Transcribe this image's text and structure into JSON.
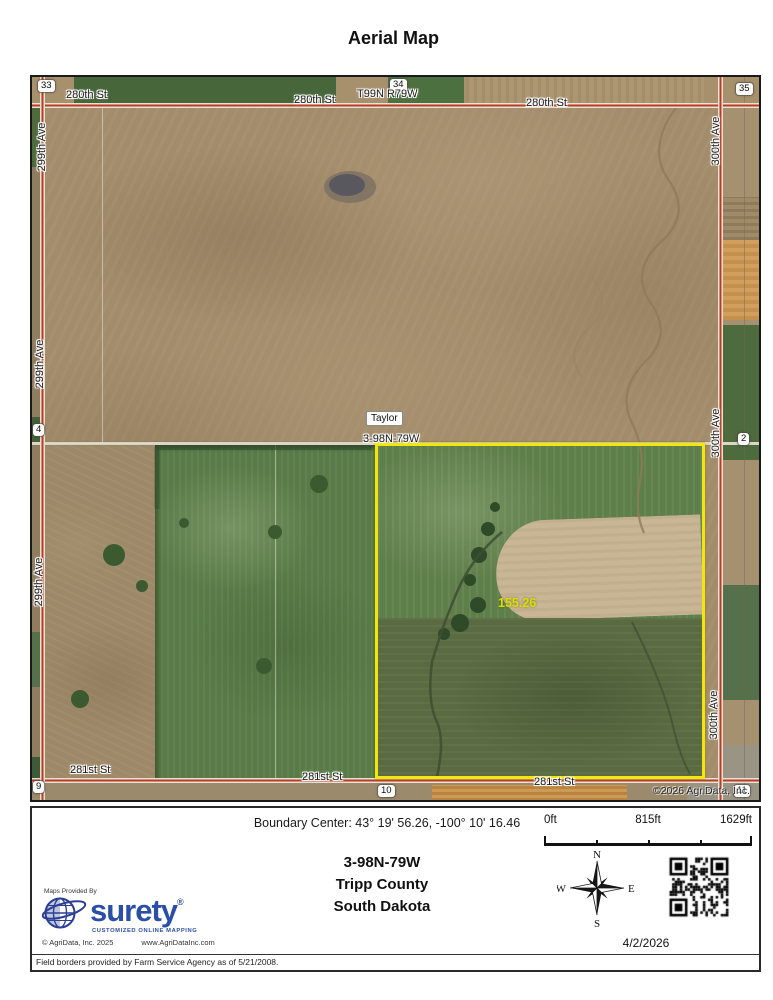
{
  "title": "Aerial Map",
  "map": {
    "streets": {
      "s280": "280th St",
      "s281": "281st St",
      "a299": "299th Ave",
      "a300": "300th Ave"
    },
    "sections": {
      "s33": "33",
      "s34": "34",
      "s35": "35",
      "s4": "4",
      "s2": "2",
      "s9": "9",
      "s10": "10",
      "s11": "11"
    },
    "township_top": "T99N R79W",
    "township_mid": "3-98N-79W",
    "place": "Taylor",
    "acres": "155.26",
    "copyright": "©2026 AgriData, Inc."
  },
  "footer": {
    "boundary_center": "Boundary Center: 43° 19' 56.26,  -100° 10' 16.46",
    "scale": {
      "zero": "0ft",
      "mid": "815ft",
      "max": "1629ft"
    },
    "trs": "3-98N-79W",
    "county": "Tripp County",
    "state": "South Dakota",
    "compass": {
      "n": "N",
      "e": "E",
      "s": "S",
      "w": "W"
    },
    "date": "4/2/2026",
    "provider": {
      "tagline": "Maps Provided By",
      "brand": "surety",
      "reg": "®",
      "subtitle": "CUSTOMIZED ONLINE MAPPING",
      "copyright": "© AgriData, Inc. 2025",
      "website": "www.AgriDataInc.com"
    },
    "disclaimer": "Field borders provided by Farm Service Agency as of 5/21/2008."
  },
  "colors": {
    "boundary_yellow": "#f2e60a",
    "road_red": "#bc3b28",
    "brand_blue": "#2b4ea8",
    "acres_label": "#d8e000"
  }
}
